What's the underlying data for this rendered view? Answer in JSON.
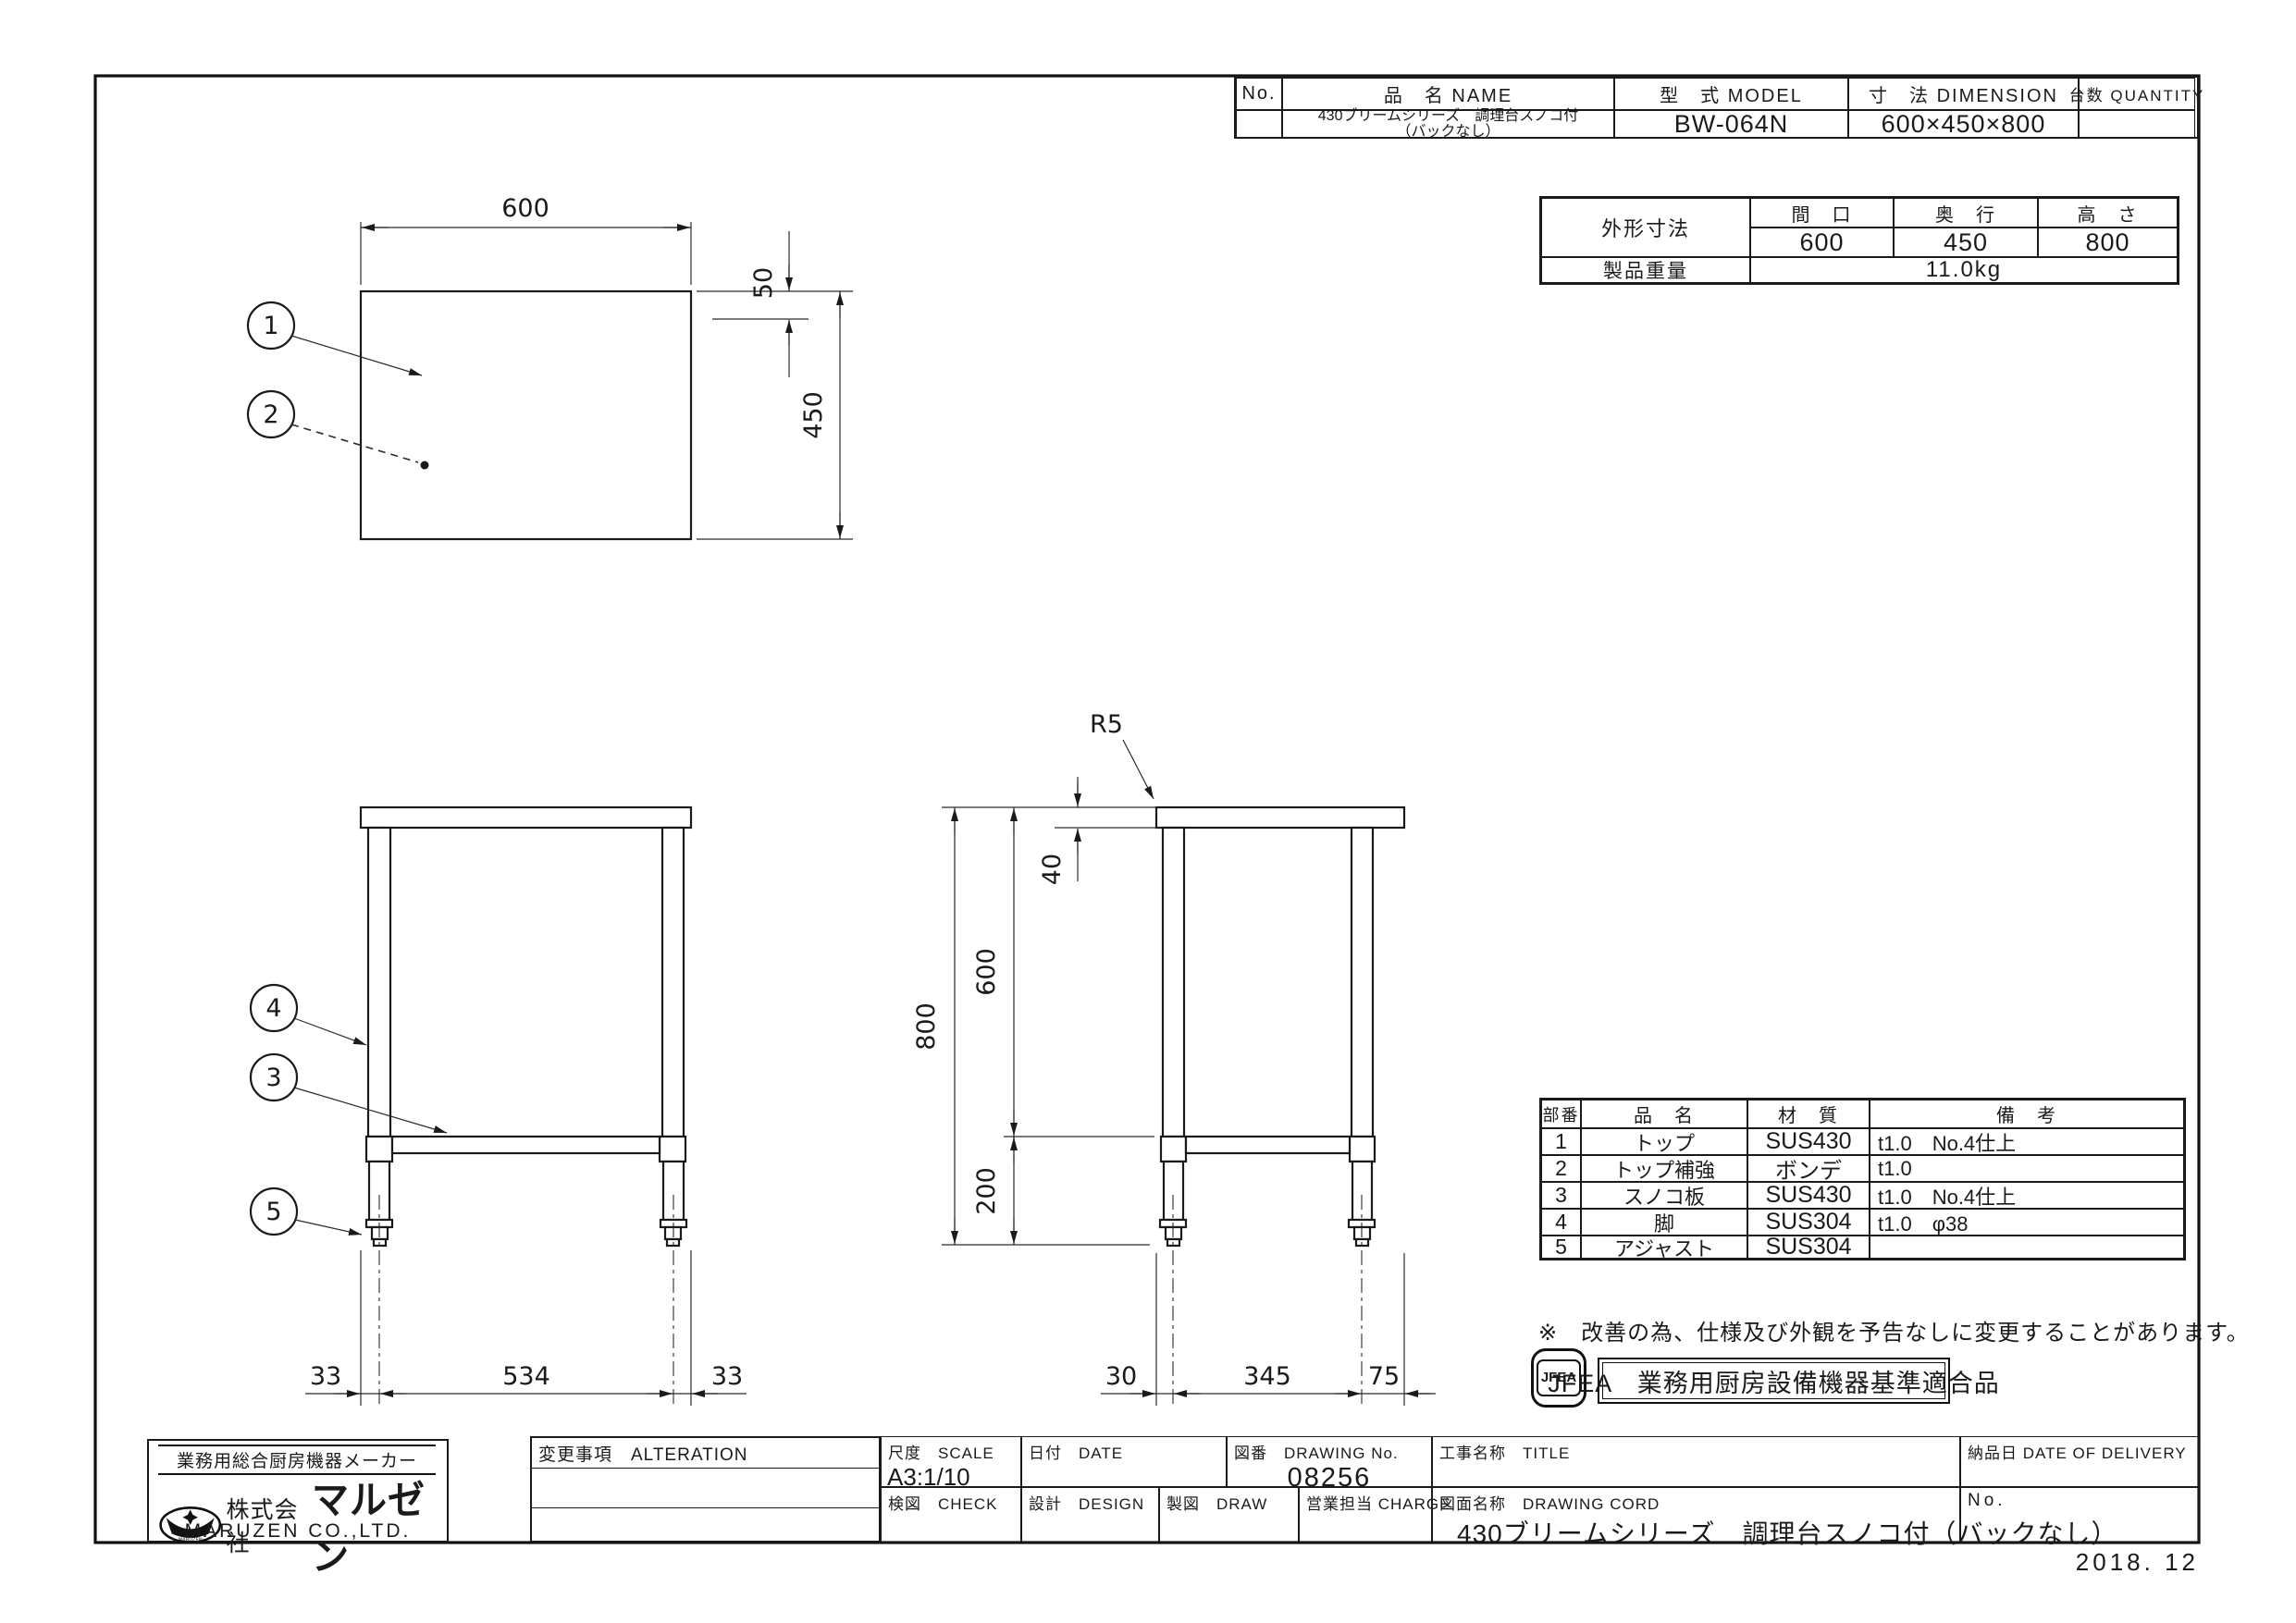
{
  "sheet": {
    "date_stamp": "2018. 12"
  },
  "spec_table": {
    "no_header": "No.",
    "name_header": "品　名 NAME",
    "model_header": "型　式 MODEL",
    "dimension_header": "寸　法 DIMENSION",
    "quantity_header": "台数 QUANTITY",
    "row": {
      "name_line1": "430ブリームシリーズ　調理台スノコ付",
      "name_line2": "（バックなし）",
      "model": "BW-064N",
      "dimension": "600×450×800"
    }
  },
  "outline_table": {
    "title": "外形寸法",
    "width_header": "間　口",
    "depth_header": "奥　行",
    "height_header": "高　さ",
    "width": "600",
    "depth": "450",
    "height": "800",
    "weight_label": "製品重量",
    "weight_value": "11.0kg"
  },
  "parts_table": {
    "headers": [
      "部番",
      "品　名",
      "材　質",
      "備　考"
    ],
    "rows": [
      [
        "1",
        "トップ",
        "SUS430",
        "t1.0　No.4仕上"
      ],
      [
        "2",
        "トップ補強",
        "ボンデ",
        "t1.0"
      ],
      [
        "3",
        "スノコ板",
        "SUS430",
        "t1.0　No.4仕上"
      ],
      [
        "4",
        "脚",
        "SUS304",
        "t1.0　φ38"
      ],
      [
        "5",
        "アジャスト",
        "SUS304",
        ""
      ]
    ]
  },
  "note": "※　改善の為、仕様及び外観を予告なしに変更することがあります。",
  "jfea": {
    "medal": "JFEA",
    "cert": "JFEA　業務用厨房設備機器基準適合品"
  },
  "company": {
    "tagline": "業務用総合厨房機器メーカー",
    "prefix": "株式会社",
    "brand": "マルゼン",
    "english": "MARUZEN CO.,LTD."
  },
  "title_block": {
    "alteration": "変更事項　ALTERATION",
    "scale_label": "尺度　SCALE",
    "scale_value": "A3:1/10",
    "date_label": "日付　DATE",
    "drawing_no_label": "図番　DRAWING No.",
    "drawing_no": "08256",
    "project_label": "工事名称　TITLE",
    "delivery_label": "納品日 DATE OF DELIVERY",
    "check_label": "検図　CHECK",
    "design_label": "設計　DESIGN",
    "draw_label": "製図　DRAW",
    "charge_label": "営業担当 CHARGE",
    "drawing_name_label": "図面名称　DRAWING CORD",
    "drawing_name": "430ブリームシリーズ　調理台スノコ付（バックなし）",
    "no_label": "No."
  },
  "drawing": {
    "plan": {
      "width": "600",
      "edge": "50",
      "depth": "450",
      "callout_top": "1",
      "callout_reinforce": "2"
    },
    "front": {
      "left": "33",
      "span": "534",
      "right": "33",
      "callout_leg": "4",
      "callout_slat": "3",
      "callout_adjuster": "5"
    },
    "side": {
      "radius": "R5",
      "top_thickness": "40",
      "upper": "600",
      "total": "800",
      "lower": "200",
      "front_offset": "30",
      "span": "345",
      "rear": "75"
    }
  }
}
